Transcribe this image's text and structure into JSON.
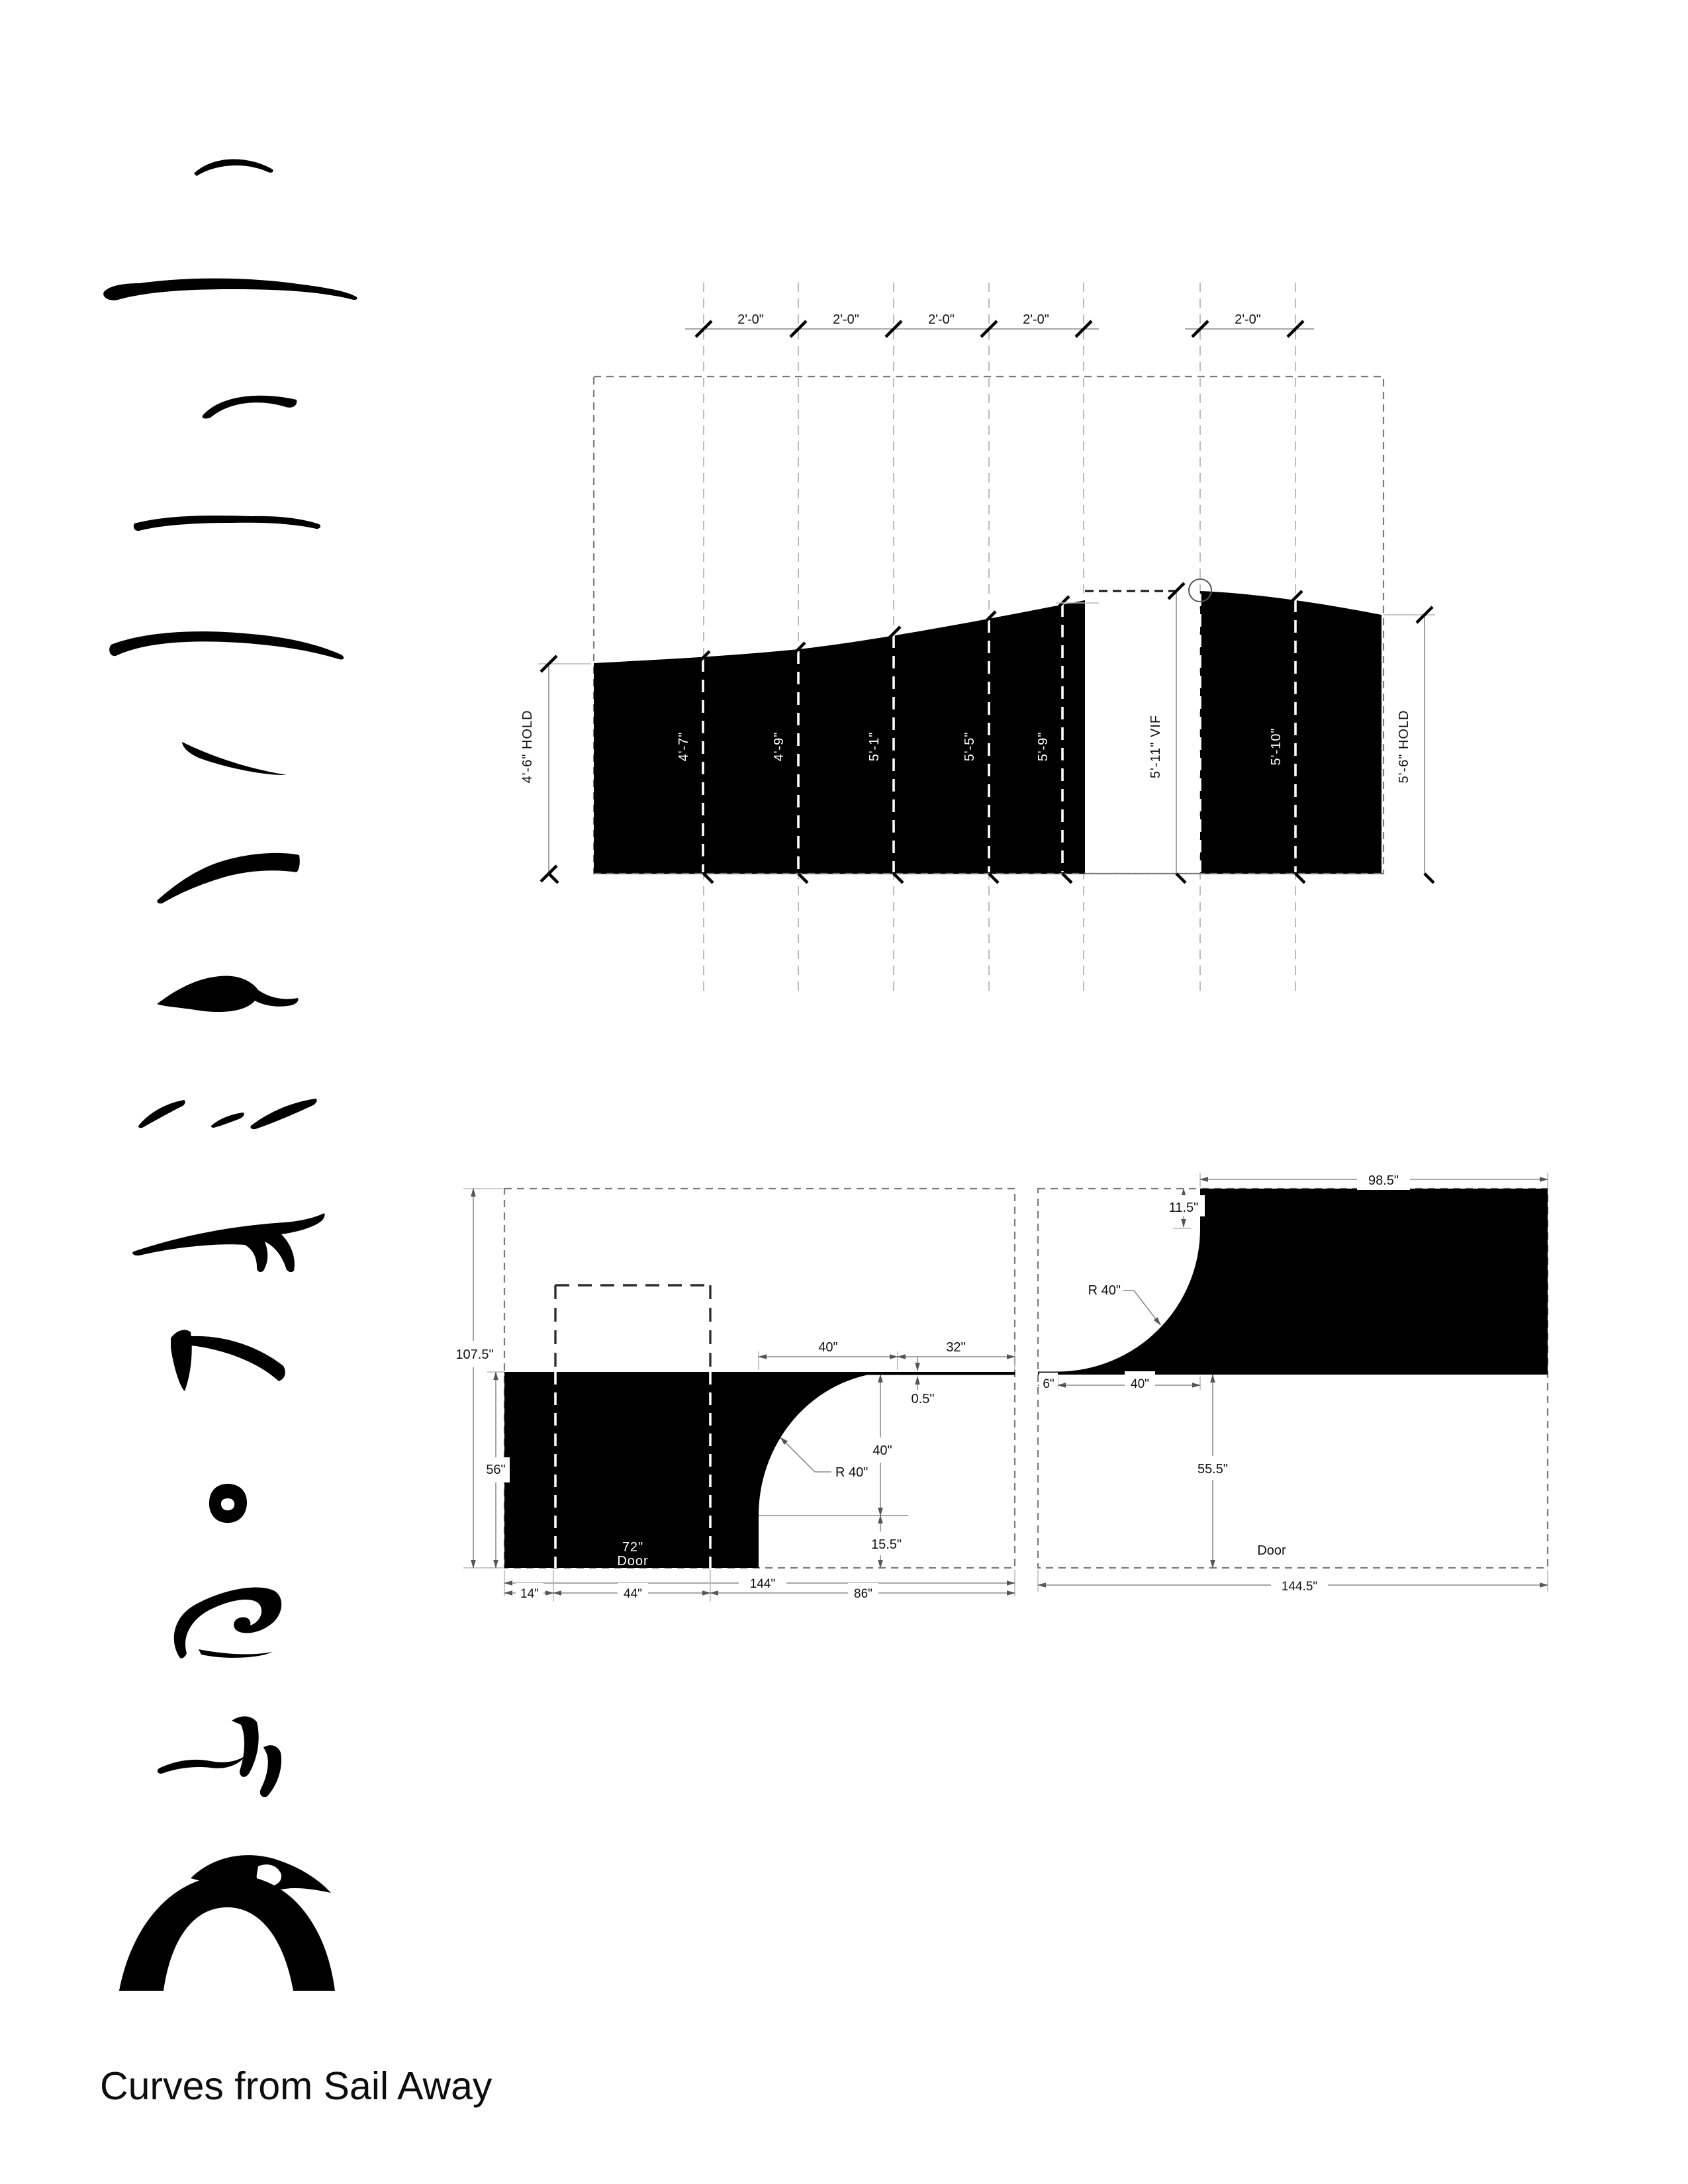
{
  "title": "Curves from Sail Away",
  "colors": {
    "ink": "#000000",
    "dim_line": "#8c8c8c",
    "grid_line": "#ababab"
  },
  "elevation": {
    "bay_labels": [
      "2'-0\"",
      "2'-0\"",
      "2'-0\"",
      "2'-0\"",
      "2'-0\""
    ],
    "left_hold_label": "4'-6\" HOLD",
    "panel_heights": [
      "4'-7\"",
      "4'-9\"",
      "5'-1\"",
      "5'-5\"",
      "5'-9\""
    ],
    "vif_label": "5'-11\" VIF",
    "right_panel_height": "5'-10\"",
    "right_hold_label": "5'-6\" HOLD"
  },
  "plan_left": {
    "overall_height": "107.5\"",
    "counter_depth": "56\"",
    "top_width_a": "40\"",
    "top_width_b": "32\"",
    "edge_thickness": "0.5\"",
    "radius_label": "R 40\"",
    "curve_height": "40\"",
    "bottom_inset": "15.5\"",
    "door_width": "72\"",
    "door_text": "Door",
    "overall_width": "144\"",
    "seg_a": "14\"",
    "seg_b": "44\"",
    "seg_c": "86\""
  },
  "plan_right": {
    "top_width": "98.5\"",
    "corner_drop": "11.5\"",
    "radius_label": "R 40\"",
    "seg_a": "6\"",
    "seg_b": "40\"",
    "door_clearance": "55.5\"",
    "door_text": "Door",
    "overall_width": "144.5\""
  }
}
